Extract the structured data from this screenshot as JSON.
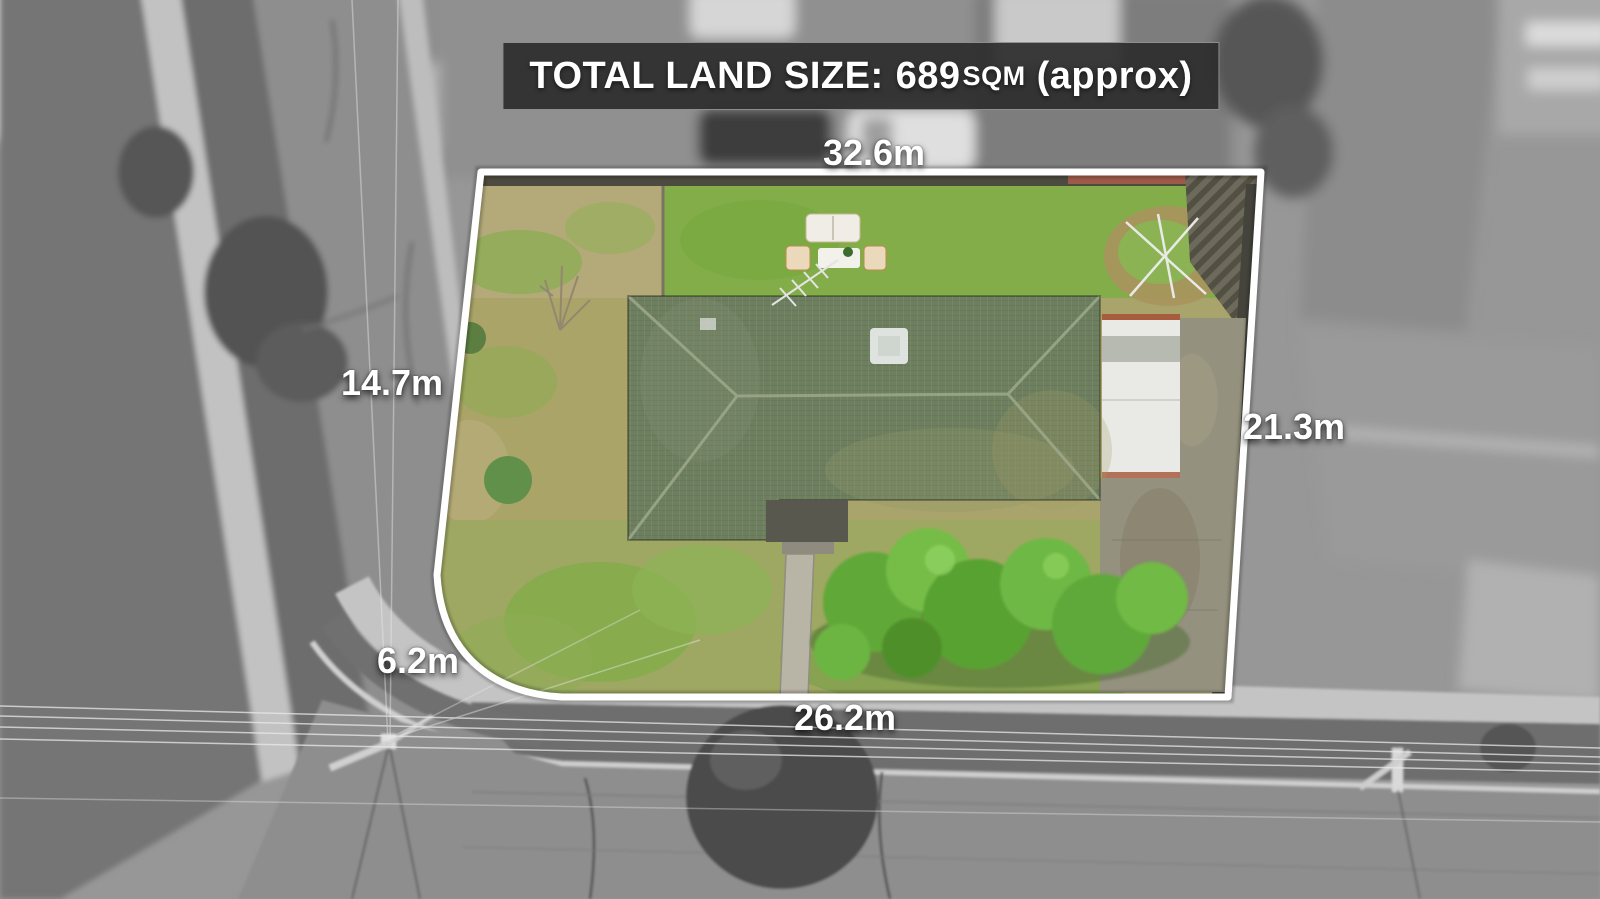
{
  "banner": {
    "label": "TOTAL LAND SIZE:",
    "value": "689",
    "unit": "SQM",
    "suffix": "(approx)"
  },
  "dimensions": {
    "top": "32.6m",
    "left": "14.7m",
    "right": "21.3m",
    "corner": "6.2m",
    "bottom": "26.2m"
  },
  "colors": {
    "banner_bg": "rgba(44,44,44,0.92)",
    "banner_border": "rgba(255,255,255,0.45)",
    "label_text": "#ffffff",
    "boundary_line": "#ffffff",
    "lawn_green": "#83ad49",
    "lawn_dry": "#b3a979",
    "roof_green": "#6d7f5f",
    "tree_green": "#61a837",
    "concrete_gray": "#94917e"
  }
}
